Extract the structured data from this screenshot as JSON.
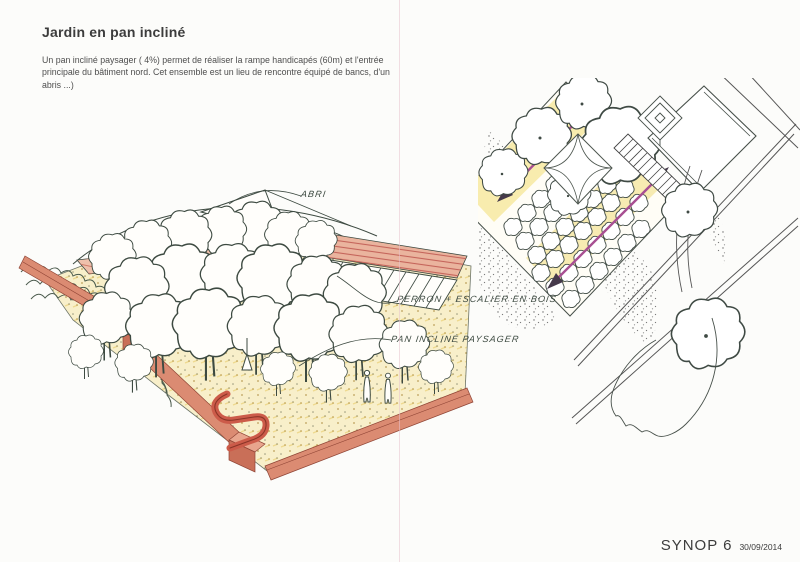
{
  "page": {
    "title": "Jardin en pan incliné",
    "description": "Un  pan incliné paysager ( 4%) permet de réaliser la rampe handicapés (60m) et l'entrée principale du bâtiment nord. Cet ensemble est un lieu de rencontre équipé de bancs, d'un abris ...)"
  },
  "annotations": {
    "shelter": "ABRI",
    "stairs": "PERRON + ESCALIER EN BOIS",
    "slope": "PAN INCLINÉ PAYSAGER"
  },
  "footer": {
    "project": "SYNOP 6",
    "date": "30/09/2014"
  },
  "colors": {
    "paper": "#fcfcfa",
    "text-dark": "#3c3c3c",
    "ink": "#3d4a41",
    "fold-pink": "#e7c3cd",
    "wall-red": "#db8b72",
    "wall-red-dark": "#8f4435",
    "ground-yellow": "#f8efca",
    "stipple-gold": "#c1a45c",
    "ramp-pink": "#eab49e",
    "arrow-magenta": "#a84f92"
  }
}
